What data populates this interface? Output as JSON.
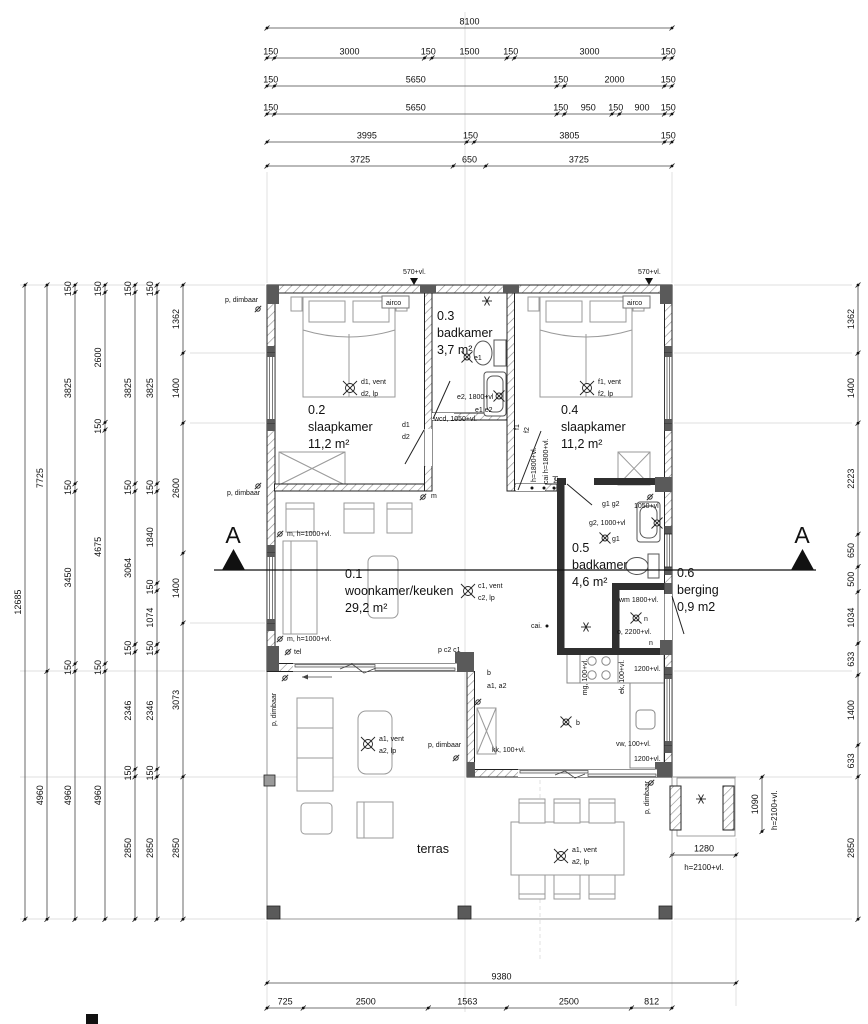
{
  "scale_px_per_mm": 0.05,
  "section": {
    "letter": "A"
  },
  "rooms": [
    {
      "number": "0.1",
      "name": "woonkamer/keuken",
      "area": "29,2 m²",
      "x": 345,
      "y": 578
    },
    {
      "number": "0.2",
      "name": "slaapkamer",
      "area": "11,2 m²",
      "x": 308,
      "y": 414
    },
    {
      "number": "0.3",
      "name": "badkamer",
      "area": "3,7 m²",
      "x": 437,
      "y": 320
    },
    {
      "number": "0.4",
      "name": "slaapkamer",
      "area": "11,2 m²",
      "x": 561,
      "y": 414
    },
    {
      "number": "0.5",
      "name": "badkamer",
      "area": "4,6 m²",
      "x": 572,
      "y": 552
    },
    {
      "number": "0.6",
      "name": "berging",
      "area": "0,9 m2",
      "x": 677,
      "y": 577
    },
    {
      "number": "",
      "name": "terras",
      "area": "",
      "x": 417,
      "y": 853
    }
  ],
  "dimension_chains": [
    {
      "name": "top-row-1",
      "orient": "h",
      "line": 28,
      "start": 267,
      "segments": [
        8100
      ]
    },
    {
      "name": "top-row-2",
      "orient": "h",
      "line": 58,
      "start": 267,
      "segments": [
        150,
        3000,
        150,
        1500,
        150,
        3000,
        150
      ]
    },
    {
      "name": "top-row-3",
      "orient": "h",
      "line": 86,
      "start": 267,
      "segments": [
        150,
        5650,
        150,
        2000,
        150
      ]
    },
    {
      "name": "top-row-4",
      "orient": "h",
      "line": 114,
      "start": 267,
      "segments": [
        150,
        5650,
        150,
        950,
        150,
        900,
        150
      ]
    },
    {
      "name": "top-row-5",
      "orient": "h",
      "line": 142,
      "start": 267,
      "segments": [
        3995,
        150,
        3805,
        150
      ]
    },
    {
      "name": "top-row-6",
      "orient": "h",
      "line": 166,
      "start": 267,
      "segments": [
        3725,
        650,
        3725
      ]
    },
    {
      "name": "bottom-row-1",
      "orient": "h",
      "line": 983,
      "start": 267,
      "segments": [
        9380
      ]
    },
    {
      "name": "bottom-row-2",
      "orient": "h",
      "line": 1008,
      "start": 267,
      "segments": [
        725,
        2500,
        1563,
        2500,
        812
      ]
    },
    {
      "name": "left-col-1",
      "orient": "v",
      "line": 25,
      "start": 285,
      "segments": [
        12685
      ]
    },
    {
      "name": "left-col-2",
      "orient": "v",
      "line": 47,
      "start": 285,
      "segments": [
        7725,
        4960
      ]
    },
    {
      "name": "left-col-3",
      "orient": "v",
      "line": 75,
      "start": 285,
      "segments": [
        150,
        3825,
        150,
        3450,
        150,
        4960
      ]
    },
    {
      "name": "left-col-4",
      "orient": "v",
      "line": 105,
      "start": 285,
      "segments": [
        150,
        2600,
        150,
        4675,
        150,
        4960
      ]
    },
    {
      "name": "left-col-5",
      "orient": "v",
      "line": 135,
      "start": 285,
      "segments": [
        150,
        3825,
        150,
        3064,
        150,
        2346,
        150,
        2850
      ]
    },
    {
      "name": "left-col-6",
      "orient": "v",
      "line": 157,
      "start": 285,
      "segments": [
        150,
        3825,
        150,
        1840,
        150,
        1074,
        150,
        2346,
        150,
        2850
      ]
    },
    {
      "name": "left-col-7",
      "orient": "v",
      "line": 183,
      "start": 285,
      "segments": [
        1362,
        1400,
        2600,
        1400,
        3073,
        2850
      ]
    },
    {
      "name": "right-col-1",
      "orient": "v",
      "line": 858,
      "start": 285,
      "segments": [
        1362,
        1400,
        2223,
        650,
        500,
        1034,
        633,
        1400,
        633,
        2850
      ]
    },
    {
      "name": "porch-width",
      "orient": "h",
      "line": 855,
      "start": 672,
      "segments": [
        1280
      ]
    },
    {
      "name": "porch-depth",
      "orient": "v",
      "line": 762,
      "start": 777,
      "segments": [
        1090
      ]
    }
  ],
  "annotations": [
    {
      "t": "p, dimbaar",
      "x": 225,
      "y": 302
    },
    {
      "t": "570+vl.",
      "x": 403,
      "y": 274
    },
    {
      "t": "570+vl.",
      "x": 638,
      "y": 274
    },
    {
      "t": "airco",
      "x": 386,
      "y": 305
    },
    {
      "t": "airco",
      "x": 627,
      "y": 305
    },
    {
      "t": "d1, vent",
      "x": 361,
      "y": 384
    },
    {
      "t": "d2, lp",
      "x": 361,
      "y": 396
    },
    {
      "t": "d1",
      "x": 402,
      "y": 427
    },
    {
      "t": "d2",
      "x": 402,
      "y": 439
    },
    {
      "t": "wcd, 1050+vl.",
      "x": 434,
      "y": 421
    },
    {
      "t": "e2, 1800+vl",
      "x": 457,
      "y": 399
    },
    {
      "t": "e1 e2",
      "x": 475,
      "y": 412
    },
    {
      "t": "e1",
      "x": 474,
      "y": 360
    },
    {
      "t": "f1, vent",
      "x": 598,
      "y": 384
    },
    {
      "t": "f2, lp",
      "x": 598,
      "y": 396
    },
    {
      "t": "f1",
      "x": 519,
      "y": 430,
      "r": -90
    },
    {
      "t": "f2",
      "x": 529,
      "y": 433,
      "r": -90
    },
    {
      "t": "h=1800+vl.",
      "x": 536,
      "y": 482,
      "r": -90
    },
    {
      "t": "cai h=1800+vl.",
      "x": 548,
      "y": 484,
      "r": -90
    },
    {
      "t": "tel",
      "x": 558,
      "y": 483,
      "r": -90
    },
    {
      "t": "p, dimbaar",
      "x": 227,
      "y": 495
    },
    {
      "t": "m",
      "x": 431,
      "y": 498
    },
    {
      "t": "m, h=1000+vl.",
      "x": 287,
      "y": 536
    },
    {
      "t": "m, h=1000+vl.",
      "x": 287,
      "y": 641
    },
    {
      "t": "tel",
      "x": 294,
      "y": 654
    },
    {
      "t": "c1, vent",
      "x": 478,
      "y": 588
    },
    {
      "t": "c2, lp",
      "x": 478,
      "y": 600
    },
    {
      "t": "g1 g2",
      "x": 602,
      "y": 506
    },
    {
      "t": "1050+vl",
      "x": 634,
      "y": 508
    },
    {
      "t": "g2, 1000+vl",
      "x": 589,
      "y": 525
    },
    {
      "t": "g1",
      "x": 612,
      "y": 541
    },
    {
      "t": "cai.",
      "x": 531,
      "y": 628
    },
    {
      "t": "wm 1800+vl.",
      "x": 619,
      "y": 602
    },
    {
      "t": "n",
      "x": 644,
      "y": 621
    },
    {
      "t": "o, 2200+vl.",
      "x": 617,
      "y": 634
    },
    {
      "t": "n",
      "x": 649,
      "y": 645
    },
    {
      "t": "p c2 c1",
      "x": 438,
      "y": 652
    },
    {
      "t": "b",
      "x": 487,
      "y": 675
    },
    {
      "t": "a1, a2",
      "x": 487,
      "y": 688
    },
    {
      "t": "kk, 100+vl.",
      "x": 492,
      "y": 752
    },
    {
      "t": "mg, 100+vl.",
      "x": 587,
      "y": 677,
      "r": -90,
      "a": "m"
    },
    {
      "t": "ek, 100+vl.",
      "x": 624,
      "y": 677,
      "r": -90,
      "a": "m"
    },
    {
      "t": "1200+vl.",
      "x": 634,
      "y": 671
    },
    {
      "t": "vw, 100+vl.",
      "x": 616,
      "y": 746
    },
    {
      "t": "1200+vl.",
      "x": 634,
      "y": 761
    },
    {
      "t": "p, dimbaar",
      "x": 428,
      "y": 747
    },
    {
      "t": "a1, vent",
      "x": 379,
      "y": 741
    },
    {
      "t": "a2, lp",
      "x": 379,
      "y": 753
    },
    {
      "t": "a1, vent",
      "x": 572,
      "y": 852
    },
    {
      "t": "a2, lp",
      "x": 572,
      "y": 864
    },
    {
      "t": "p, dimbaar",
      "x": 649,
      "y": 814,
      "r": -90
    },
    {
      "t": "h=2100+vl.",
      "x": 704,
      "y": 870,
      "s": 8,
      "a": "m"
    },
    {
      "t": "h=2100+vl.",
      "x": 777,
      "y": 830,
      "r": -90,
      "s": 8
    },
    {
      "t": "p, dimbaar",
      "x": 276,
      "y": 726,
      "r": -90
    },
    {
      "t": "b",
      "x": 576,
      "y": 725
    }
  ],
  "symbols": [
    {
      "type": "lamp",
      "x": 350,
      "y": 388
    },
    {
      "type": "lamp",
      "x": 587,
      "y": 388
    },
    {
      "type": "lamp",
      "x": 468,
      "y": 591
    },
    {
      "type": "lamp",
      "x": 368,
      "y": 744
    },
    {
      "type": "lamp",
      "x": 561,
      "y": 856
    },
    {
      "type": "lampS",
      "x": 467,
      "y": 357
    },
    {
      "type": "lampS",
      "x": 605,
      "y": 538
    },
    {
      "type": "lampS",
      "x": 636,
      "y": 618
    },
    {
      "type": "lampS",
      "x": 566,
      "y": 722
    },
    {
      "type": "lampS",
      "x": 499,
      "y": 396
    },
    {
      "type": "lampS",
      "x": 657,
      "y": 523
    },
    {
      "type": "star",
      "x": 487,
      "y": 301
    },
    {
      "type": "star",
      "x": 586,
      "y": 627
    },
    {
      "type": "star",
      "x": 701,
      "y": 799
    },
    {
      "type": "socket",
      "x": 258,
      "y": 309
    },
    {
      "type": "socket",
      "x": 258,
      "y": 486
    },
    {
      "type": "socket",
      "x": 280,
      "y": 534
    },
    {
      "type": "socket",
      "x": 280,
      "y": 639
    },
    {
      "type": "socket",
      "x": 288,
      "y": 652
    },
    {
      "type": "socket",
      "x": 423,
      "y": 497
    },
    {
      "type": "socket",
      "x": 478,
      "y": 702
    },
    {
      "type": "socket",
      "x": 285,
      "y": 678
    },
    {
      "type": "socket",
      "x": 456,
      "y": 758
    },
    {
      "type": "socket",
      "x": 651,
      "y": 783
    },
    {
      "type": "socket",
      "x": 650,
      "y": 497
    },
    {
      "type": "dot",
      "x": 547,
      "y": 626
    },
    {
      "type": "dot",
      "x": 532,
      "y": 488
    },
    {
      "type": "dot",
      "x": 544,
      "y": 488
    },
    {
      "type": "dot",
      "x": 554,
      "y": 488
    }
  ]
}
